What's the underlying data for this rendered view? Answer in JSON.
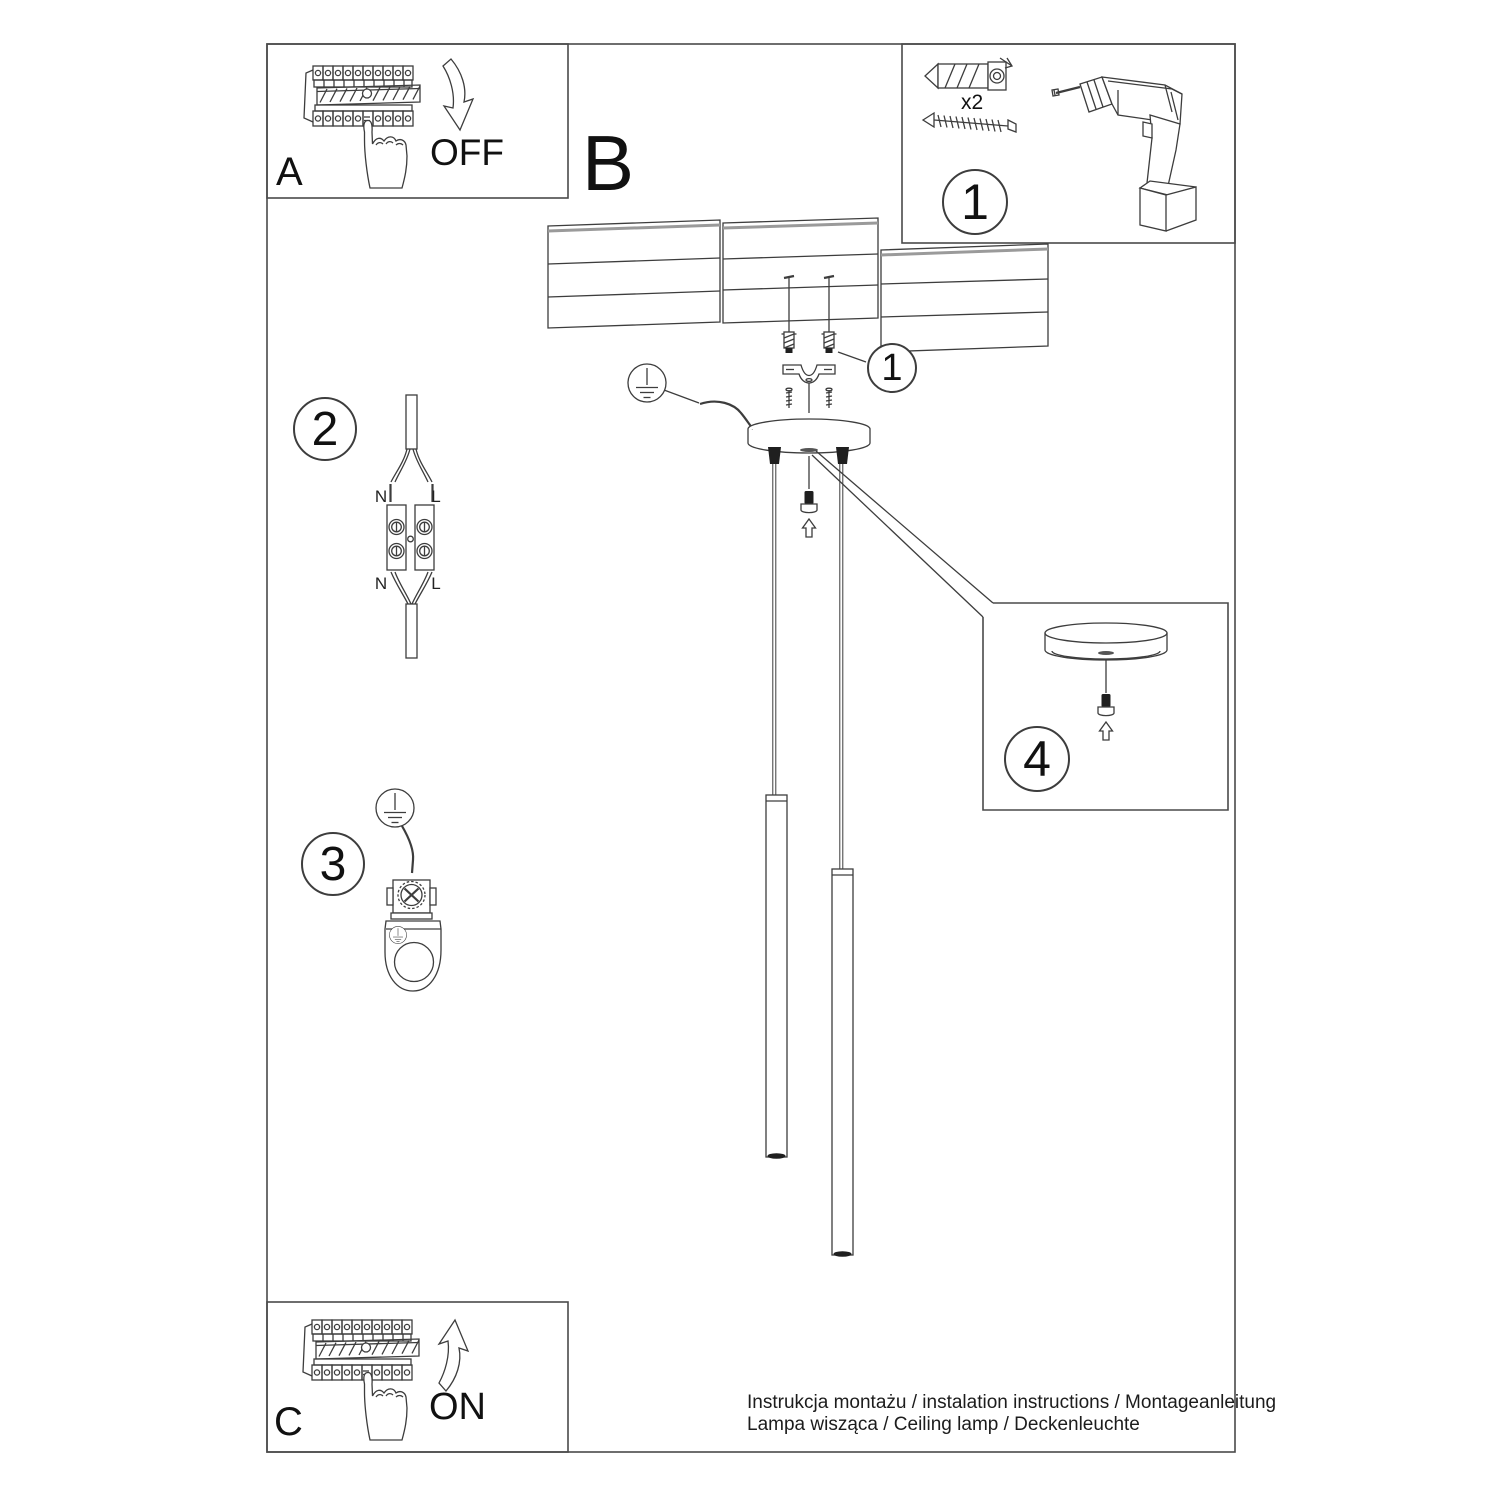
{
  "page": {
    "background": "#ffffff",
    "line_color": "#3d3d3d"
  },
  "panel_a": {
    "label": "A",
    "switch_state": "OFF"
  },
  "section_b": {
    "label": "B"
  },
  "panel_c": {
    "label": "C",
    "switch_state": "ON"
  },
  "tools_panel": {
    "step": "1",
    "anchor_quantity": "x2"
  },
  "callouts": {
    "anchors": "1",
    "wiring": "2",
    "grounding": "3",
    "canopy": "4"
  },
  "terminal": {
    "n_top": "N",
    "l_top": "L",
    "n_bottom": "N",
    "l_bottom": "L"
  },
  "footer": {
    "line1": "Instrukcja montażu / instalation instructions / Montageanleitung",
    "line2": "Lampa wisząca / Ceiling lamp / Deckenleuchte"
  }
}
